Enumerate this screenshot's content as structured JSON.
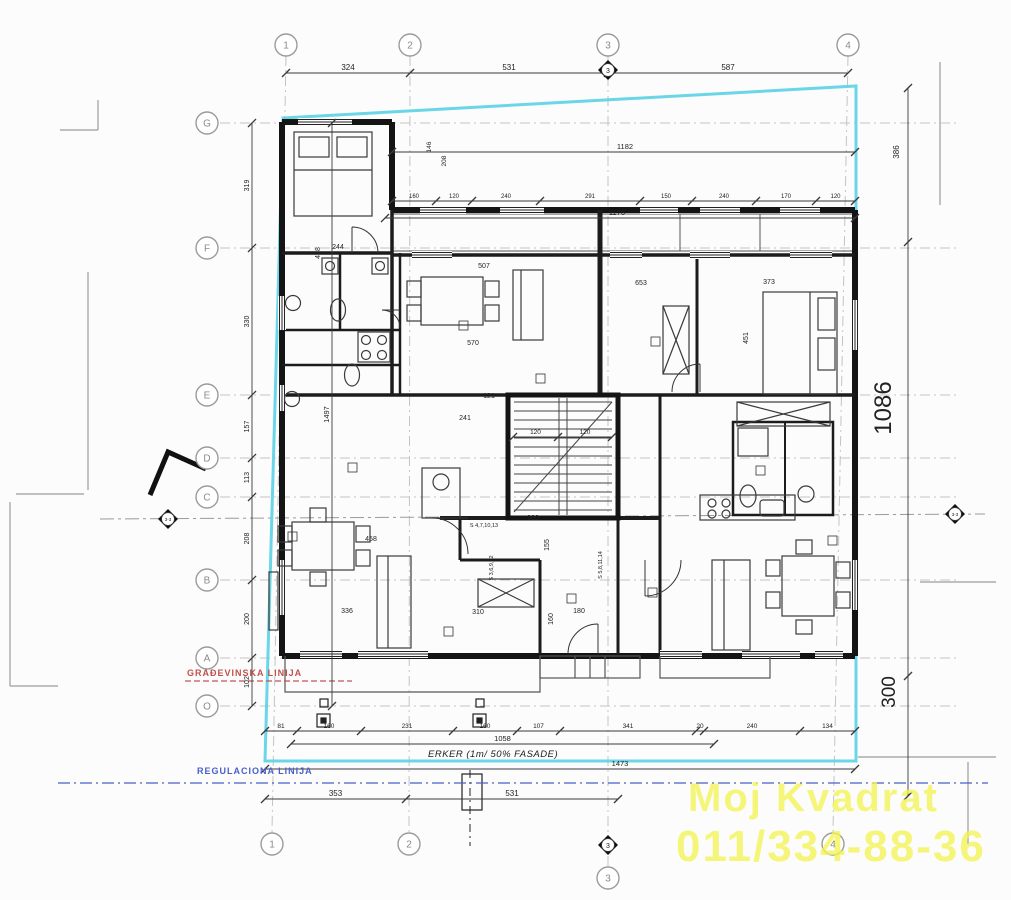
{
  "site": {
    "building_line": "GRAĐEVINSKA LINIJA",
    "building_line_color": "#c0504d",
    "regulation_line": "REGULACIONA LINIJA",
    "regulation_line_color": "#4a5fc8",
    "erker": "ERKER (1m/ 50% FASADE)",
    "parcel_boundary_color": "#5ad2e4"
  },
  "watermark": {
    "line1": "Moj Kvadrat",
    "line2": "011/334-88-36",
    "color": "#f4f455"
  },
  "axes": {
    "top": [
      {
        "label": "1",
        "x": 286
      },
      {
        "label": "2",
        "x": 410
      },
      {
        "label": "3",
        "x": 608
      },
      {
        "label": "4",
        "x": 848
      }
    ],
    "bottom": [
      {
        "label": "1",
        "x": 272
      },
      {
        "label": "2",
        "x": 409
      },
      {
        "label": "3",
        "x": 608,
        "y": 878
      },
      {
        "label": "4",
        "x": 833
      }
    ],
    "left": [
      {
        "label": "G",
        "y": 123
      },
      {
        "label": "F",
        "y": 248
      },
      {
        "label": "E",
        "y": 395
      },
      {
        "label": "D",
        "y": 458
      },
      {
        "label": "C",
        "y": 497
      },
      {
        "label": "B",
        "y": 580
      },
      {
        "label": "A",
        "y": 658
      },
      {
        "label": "O",
        "y": 706
      }
    ],
    "section_top": "3",
    "section_bottom": "3",
    "section_left": "3-3",
    "section_right": "3-3"
  },
  "dimensions": {
    "chains": [
      {
        "id": "top-main",
        "dir": "h",
        "y": 73,
        "pts": [
          286,
          410,
          608,
          848
        ],
        "labels": [
          "324",
          "531",
          "587"
        ],
        "s": 8
      },
      {
        "id": "top-1182",
        "dir": "h",
        "y": 152,
        "pts": [
          392,
          855
        ],
        "labels": [
          "1182"
        ],
        "lx": 625,
        "s": 7.5
      },
      {
        "id": "top-small",
        "dir": "h",
        "y": 201,
        "pts": [
          392,
          436,
          472,
          540,
          640,
          692,
          756,
          816,
          855
        ],
        "labels": [
          "160",
          "120",
          "240",
          "291",
          "150",
          "240",
          "170",
          "120"
        ],
        "s": 6
      },
      {
        "id": "top-1176",
        "dir": "h",
        "y": 218,
        "pts": [
          385,
          855
        ],
        "labels": [
          "1176"
        ],
        "lx": 617,
        "s": 7.5
      },
      {
        "id": "stair-inner",
        "dir": "h",
        "y": 437,
        "pts": [
          513,
          558,
          612
        ],
        "labels": [
          "120",
          "120"
        ],
        "s": 6.5
      },
      {
        "id": "bottom-outer",
        "dir": "h",
        "y": 731,
        "pts": [
          265,
          297,
          361,
          453,
          517,
          560,
          696,
          704,
          800,
          855
        ],
        "labels": [
          "81",
          "160",
          "231",
          "160",
          "107",
          "341",
          "20",
          "240",
          "134"
        ],
        "s": 6.5
      },
      {
        "id": "bottom-1058",
        "dir": "h",
        "y": 744,
        "pts": [
          291,
          714
        ],
        "labels": [
          "1058"
        ],
        "s": 7.5
      },
      {
        "id": "bottom-1473",
        "dir": "h",
        "y": 769,
        "pts": [
          265,
          855
        ],
        "labels": [
          "1473"
        ],
        "lx": 620,
        "s": 7.5
      },
      {
        "id": "bottom-blocks",
        "dir": "h",
        "y": 799,
        "pts": [
          265,
          406,
          618
        ],
        "labels": [
          "353",
          "531"
        ],
        "s": 8
      },
      {
        "id": "left-axes",
        "dir": "v",
        "x": 252,
        "pts": [
          123,
          248,
          395,
          458,
          497,
          580,
          658,
          706
        ],
        "labels": [
          "319",
          "330",
          "157",
          "113",
          "208",
          "200",
          "102"
        ],
        "s": 7
      },
      {
        "id": "left-total",
        "dir": "v",
        "x": 332,
        "pts": [
          123,
          706
        ],
        "labels": [
          "1497"
        ],
        "s": 7.5
      },
      {
        "id": "right-col",
        "dir": "v",
        "x": 908,
        "pts": [
          88,
          242,
          676,
          796
        ],
        "labels": [
          "",
          "",
          ""
        ],
        "s": 7
      }
    ],
    "annotations": [
      {
        "t": "146",
        "x": 431,
        "y": 147,
        "r": -90,
        "s": 6.5
      },
      {
        "t": "208",
        "x": 446,
        "y": 161,
        "r": -90,
        "s": 6.5
      },
      {
        "t": "418",
        "x": 320,
        "y": 253,
        "r": -90,
        "s": 7
      },
      {
        "t": "244",
        "x": 338,
        "y": 249,
        "s": 7
      },
      {
        "t": "507",
        "x": 484,
        "y": 268,
        "s": 7
      },
      {
        "t": "570",
        "x": 473,
        "y": 345,
        "s": 7
      },
      {
        "t": "121",
        "x": 489,
        "y": 398,
        "s": 7
      },
      {
        "t": "241",
        "x": 465,
        "y": 420,
        "s": 7
      },
      {
        "t": "653",
        "x": 641,
        "y": 285,
        "s": 7
      },
      {
        "t": "373",
        "x": 769,
        "y": 284,
        "s": 7
      },
      {
        "t": "451",
        "x": 748,
        "y": 338,
        "r": -90,
        "s": 7
      },
      {
        "t": "458",
        "x": 371,
        "y": 541,
        "s": 7
      },
      {
        "t": "336",
        "x": 347,
        "y": 613,
        "s": 7
      },
      {
        "t": "310",
        "x": 478,
        "y": 614,
        "s": 7
      },
      {
        "t": "360",
        "x": 533,
        "y": 520,
        "s": 7
      },
      {
        "t": "180",
        "x": 579,
        "y": 613,
        "s": 7
      },
      {
        "t": "160",
        "x": 553,
        "y": 619,
        "r": -90,
        "s": 7
      },
      {
        "t": "155",
        "x": 549,
        "y": 545,
        "r": -90,
        "s": 7
      },
      {
        "t": "386",
        "x": 899,
        "y": 152,
        "r": -90,
        "s": 8
      },
      {
        "t": "1086",
        "x": 891,
        "y": 408,
        "r": -90,
        "s": 24
      },
      {
        "t": "300",
        "x": 895,
        "y": 692,
        "r": -90,
        "s": 19
      },
      {
        "t": "S 4,7,10,13",
        "x": 484,
        "y": 527,
        "s": 5.5
      },
      {
        "t": "S 3,6,9,12",
        "x": 493,
        "y": 568,
        "r": -90,
        "s": 5.5
      },
      {
        "t": "S 5,8,11,14",
        "x": 602,
        "y": 565,
        "r": -90,
        "s": 5.5
      }
    ]
  }
}
